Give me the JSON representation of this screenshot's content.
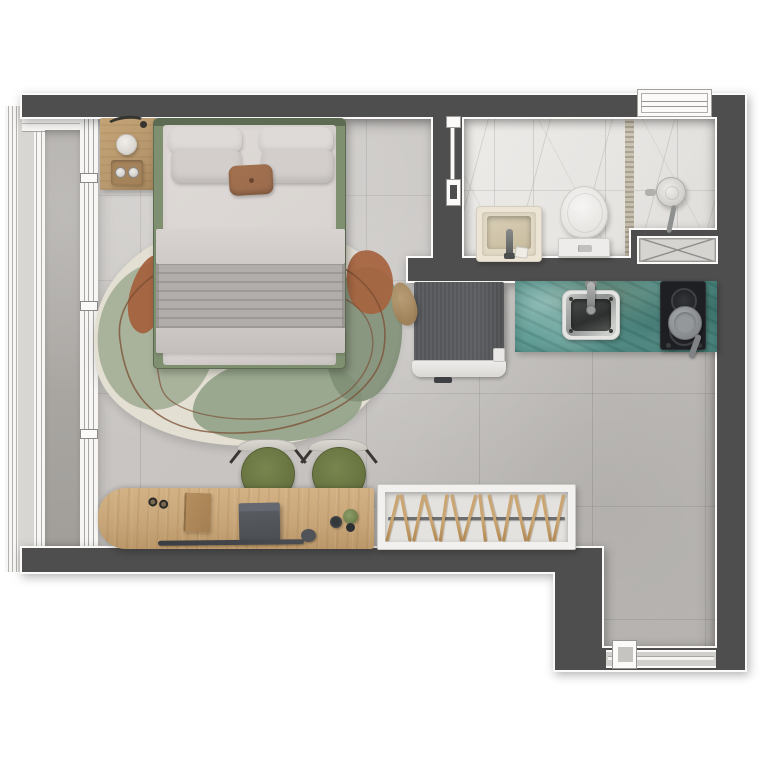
{
  "meta": {
    "type": "floor-plan-render",
    "view": "top-down",
    "description": "Top-view 3D rendered floor plan of a studio apartment with balcony, bedroom and living area, marble bathroom, teal-counter kitchenette and entry hall"
  },
  "colors": {
    "wall": "#4e4e4e",
    "floor": "#c6c3c0",
    "balcony_floor": "#aba8a4",
    "marble": "#e7e5e2",
    "counter_teal": "#5f9c95",
    "bed_green": "#7f9071",
    "bedding": "#d9d4d1",
    "blanket": "#b1adaa",
    "pillow_brown": "#9a6b4d",
    "rug_cream": "#e3dfd3",
    "rug_sage": "#a5b099",
    "rug_terracotta": "#a4623e",
    "desk_wood": "#c7a578",
    "nightstand_wood": "#b7986e",
    "chair_olive": "#67733f",
    "hanger_tan": "#b08751",
    "cooktop": "#1e1f22",
    "appliance": "#55575a",
    "fixture_white": "#f2f1ef"
  },
  "rooms": {
    "bedroom_living": {
      "label": "bedroom-living area",
      "items": [
        "double-bed",
        "pillows",
        "accent-pillow",
        "folded-blanket",
        "nightstand",
        "table-lamp",
        "vase",
        "tray",
        "area-rug",
        "desk",
        "desk-chair-left",
        "desk-chair-right",
        "laptop",
        "folder",
        "glasses",
        "mouse",
        "plant-pot",
        "open-hanger-rack"
      ]
    },
    "bathroom": {
      "label": "bathroom",
      "items": [
        "washbasin",
        "faucet",
        "toilet",
        "shower-head",
        "mosaic-floor-border",
        "window",
        "sliding-door",
        "service-shaft"
      ]
    },
    "kitchen": {
      "label": "kitchenette",
      "items": [
        "stone-counter",
        "undermount-sink",
        "kitchen-faucet",
        "two-burner-cooktop",
        "frying-pan",
        "built-in-appliance",
        "pouf"
      ]
    },
    "balcony": {
      "label": "balcony",
      "items": [
        "glass-railing",
        "sliding-glass-doors"
      ]
    },
    "entry": {
      "label": "entry hall",
      "items": [
        "entrance-door",
        "threshold"
      ]
    }
  },
  "closet": {
    "hanger_count": 14,
    "hanger_angles": [
      14,
      -11,
      12,
      -15,
      8,
      -12,
      15,
      -7,
      -14,
      10,
      -13,
      14,
      -10,
      12
    ]
  },
  "cooktop": {
    "burner_count": 2
  },
  "chairs": {
    "count": 2
  }
}
